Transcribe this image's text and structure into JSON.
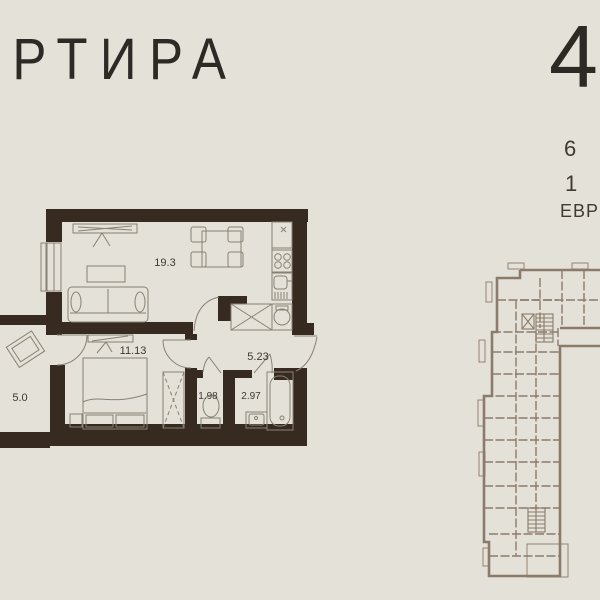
{
  "header": {
    "title_partial_letter": "А",
    "title": "РТИРА",
    "number": "4"
  },
  "info": {
    "items": [
      "6",
      "1",
      "ЕВР"
    ]
  },
  "plan": {
    "rooms": [
      {
        "id": "living-kitchen",
        "area": "19.3"
      },
      {
        "id": "bedroom",
        "area": "11.13"
      },
      {
        "id": "hallway",
        "area": "5.23"
      },
      {
        "id": "loggia",
        "area": "5.0"
      },
      {
        "id": "wc",
        "area": "1.98"
      },
      {
        "id": "bathroom",
        "area": "2.97"
      }
    ]
  },
  "colors": {
    "background": "#e3e1d8",
    "walls": "#372b21",
    "furniture_lines": "#8a8173",
    "key_plan": "#8c7b6a",
    "text": "#2d2a26",
    "labels": "#3f3a33"
  }
}
